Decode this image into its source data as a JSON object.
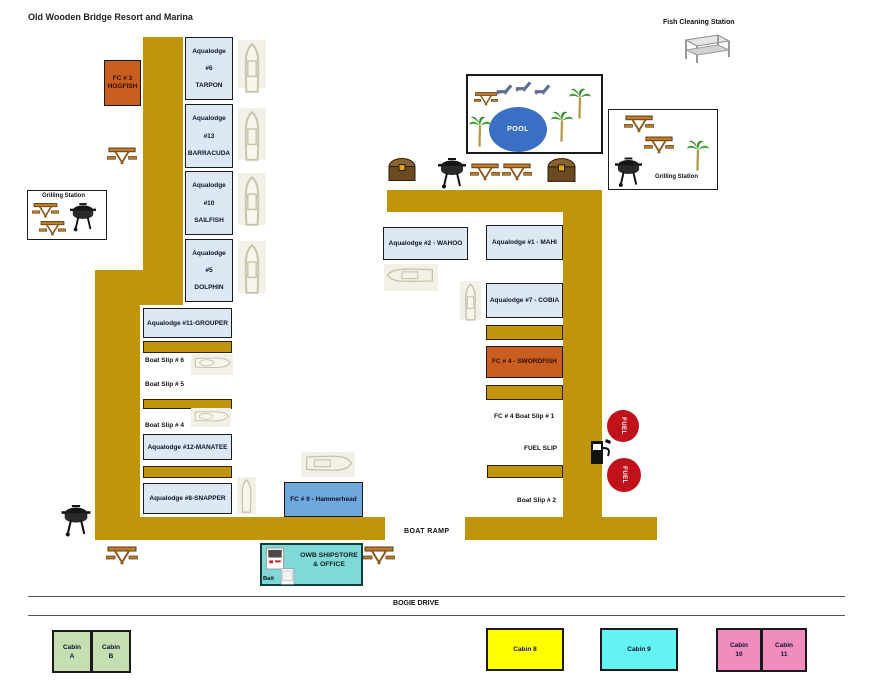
{
  "title": "Old Wooden Bridge Resort and Marina",
  "stations": {
    "fish_cleaning": "Fish Cleaning Station",
    "grilling": "Grilling Station"
  },
  "pool_label": "POOL",
  "left": {
    "fc3_line1": "FC # 3",
    "fc3_line2": "HOGFISH",
    "lodges": [
      {
        "l1": "Aqualodge",
        "l2": "#6",
        "l3": "TARPON"
      },
      {
        "l1": "Aqualodge",
        "l2": "#13",
        "l3": "BARRACUDA"
      },
      {
        "l1": "Aqualodge",
        "l2": "#10",
        "l3": "SAILFISH"
      },
      {
        "l1": "Aqualodge",
        "l2": "#5",
        "l3": "DOLPHIN"
      }
    ],
    "grouper": "Aqualodge #11-GROUPER",
    "slip6": "Boat Slip # 6",
    "slip5": "Boat Slip # 5",
    "slip4": "Boat Slip # 4",
    "manatee": "Aqualodge #12-MANATEE",
    "snapper": "Aqualodge #8-SNAPPER"
  },
  "center": {
    "fc9": "FC # 9 - Hammerhead",
    "shipstore_l1": "OWB SHIPSTORE",
    "shipstore_l2": "& OFFICE",
    "bait": "Bait",
    "boat_ramp": "BOAT RAMP",
    "road": "BOGIE DRIVE"
  },
  "right": {
    "wahoo": "Aqualodge #2 - WAHOO",
    "mahi": "Aqualodge #1 - MAHI",
    "cobia": "Aqualodge #7 - COBIA",
    "swordfish": "FC # 4 - SWORDFISH",
    "fc4_slip": "FC # 4 Boat Slip # 1",
    "fuel_slip": "FUEL SLIP",
    "slip2": "Boat Slip # 2",
    "fuel": "FUEL"
  },
  "cabins": {
    "a_l1": "Cabin",
    "a_l2": "A",
    "b_l1": "Cabin",
    "b_l2": "B",
    "c8": "Cabin 8",
    "c9": "Cabin 9",
    "c10_l1": "Cabin",
    "c10_l2": "10",
    "c11_l1": "Cabin",
    "c11_l2": "11"
  },
  "icons": {
    "picnic-table-icon": "svg orange picnic table",
    "grill-icon": "svg black bbq grill",
    "palm-tree-icon": "svg green palm tree",
    "treasure-chest-icon": "svg brown treasure chest",
    "boat-icon": "svg boat outline on pale slip",
    "lounge-chair-icon": "svg gray lounge chair",
    "fish-cleaning-table-icon": "svg steel table",
    "fuel-pump-icon": "svg black fuel pump",
    "ice-machine-icon": "svg white ice machine"
  },
  "colors": {
    "dock": "#C0940B",
    "lodge_bg": "#DCE9F5",
    "fc_orange": "#C95E20",
    "fc9_blue": "#6FA8DC",
    "shipstore_teal": "#7FD9D9",
    "pool_blue": "#3A6FC4",
    "fuel_red": "#C1121C",
    "cabin_green": "#C5DFB3",
    "cabin_yellow": "#FFFF00",
    "cabin_cyan": "#63F3F3",
    "cabin_pink": "#F08CBE"
  }
}
